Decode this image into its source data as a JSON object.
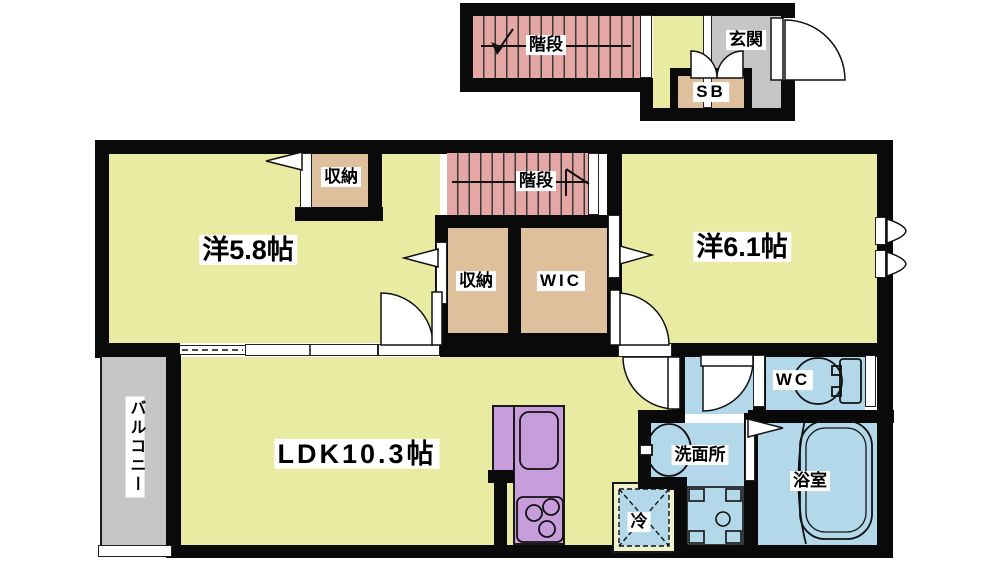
{
  "floor_plan": {
    "upper_floor": {
      "stairs": "階段",
      "entrance": "玄関",
      "shoe_box": "SB"
    },
    "main_floor": {
      "bedroom_west": "洋5.8帖",
      "bedroom_west_closet": "収納",
      "stairs": "階段",
      "closet": "収納",
      "walk_in_closet": "WIC",
      "bedroom_east": "洋6.1帖",
      "ldk": "LDK10.3帖",
      "balcony": "バルコニー",
      "washroom": "洗面所",
      "toilet": "WC",
      "bathroom": "浴室",
      "refrigerator": "冷"
    }
  },
  "palette": {
    "wall": "#0a0a0a",
    "room_green": "#e9eba3",
    "stairs_pink": "#e5a7a4",
    "stairs_stripe": "#3a3a3a",
    "closet_tan": "#dec09d",
    "water_blue": "#b3d8e9",
    "kitchen_purple": "#c79edb",
    "entrance_gray": "#c6c6c6",
    "fridge_cream": "#f1f2ca",
    "label_bg": "#ffffff",
    "background": "#ffffff"
  }
}
